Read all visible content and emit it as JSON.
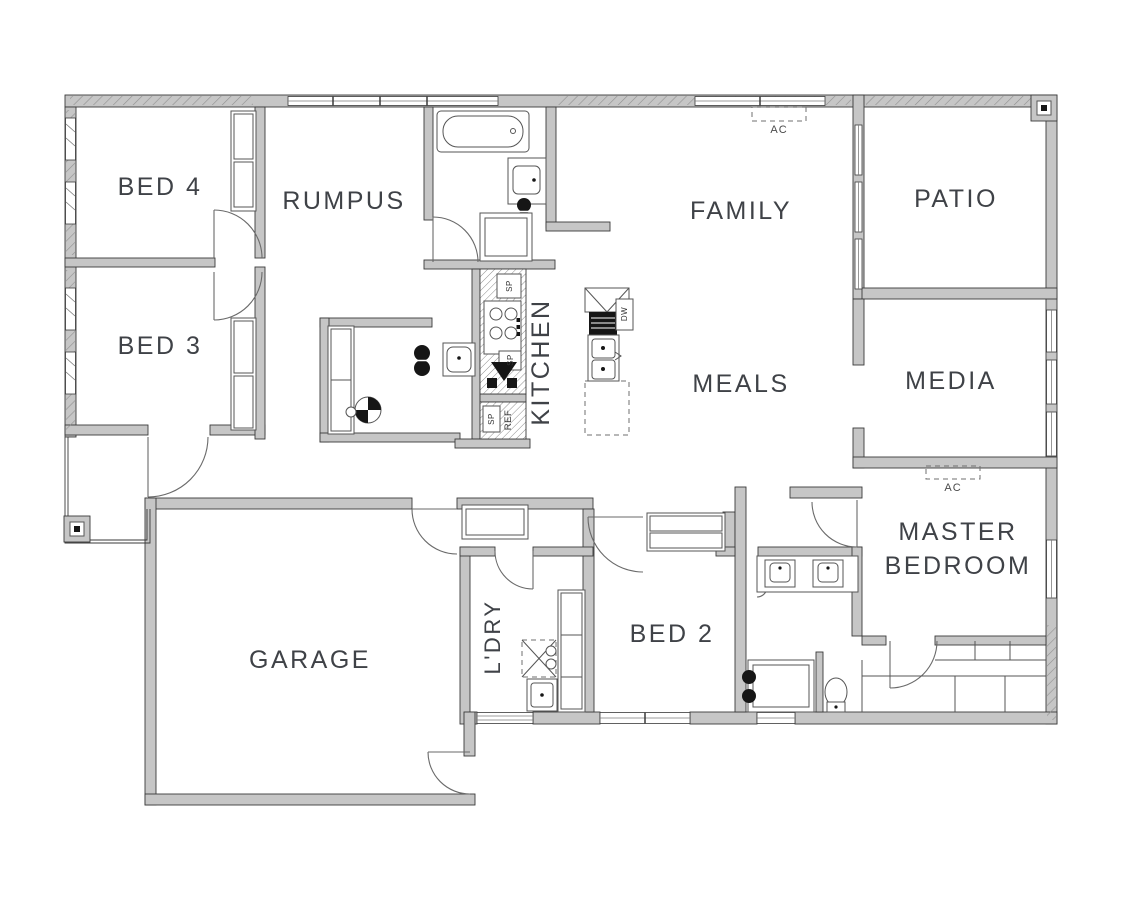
{
  "rooms": {
    "bed4": "BED 4",
    "bed3": "BED 3",
    "bed2": "BED 2",
    "rumpus": "RUMPUS",
    "kitchen": "KITCHEN",
    "family": "FAMILY",
    "patio": "PATIO",
    "meals": "MEALS",
    "media": "MEDIA",
    "garage": "GARAGE",
    "laundry": "L'DRY",
    "master_line1": "MASTER",
    "master_line2": "BEDROOM"
  },
  "annotations": {
    "ac": "AC",
    "ref": "REF",
    "sp": "SP",
    "dw": "DW"
  },
  "colors": {
    "wall": "#c6c6c6",
    "line": "#3a3a3a",
    "text": "#3f4247",
    "bg": "#ffffff"
  }
}
